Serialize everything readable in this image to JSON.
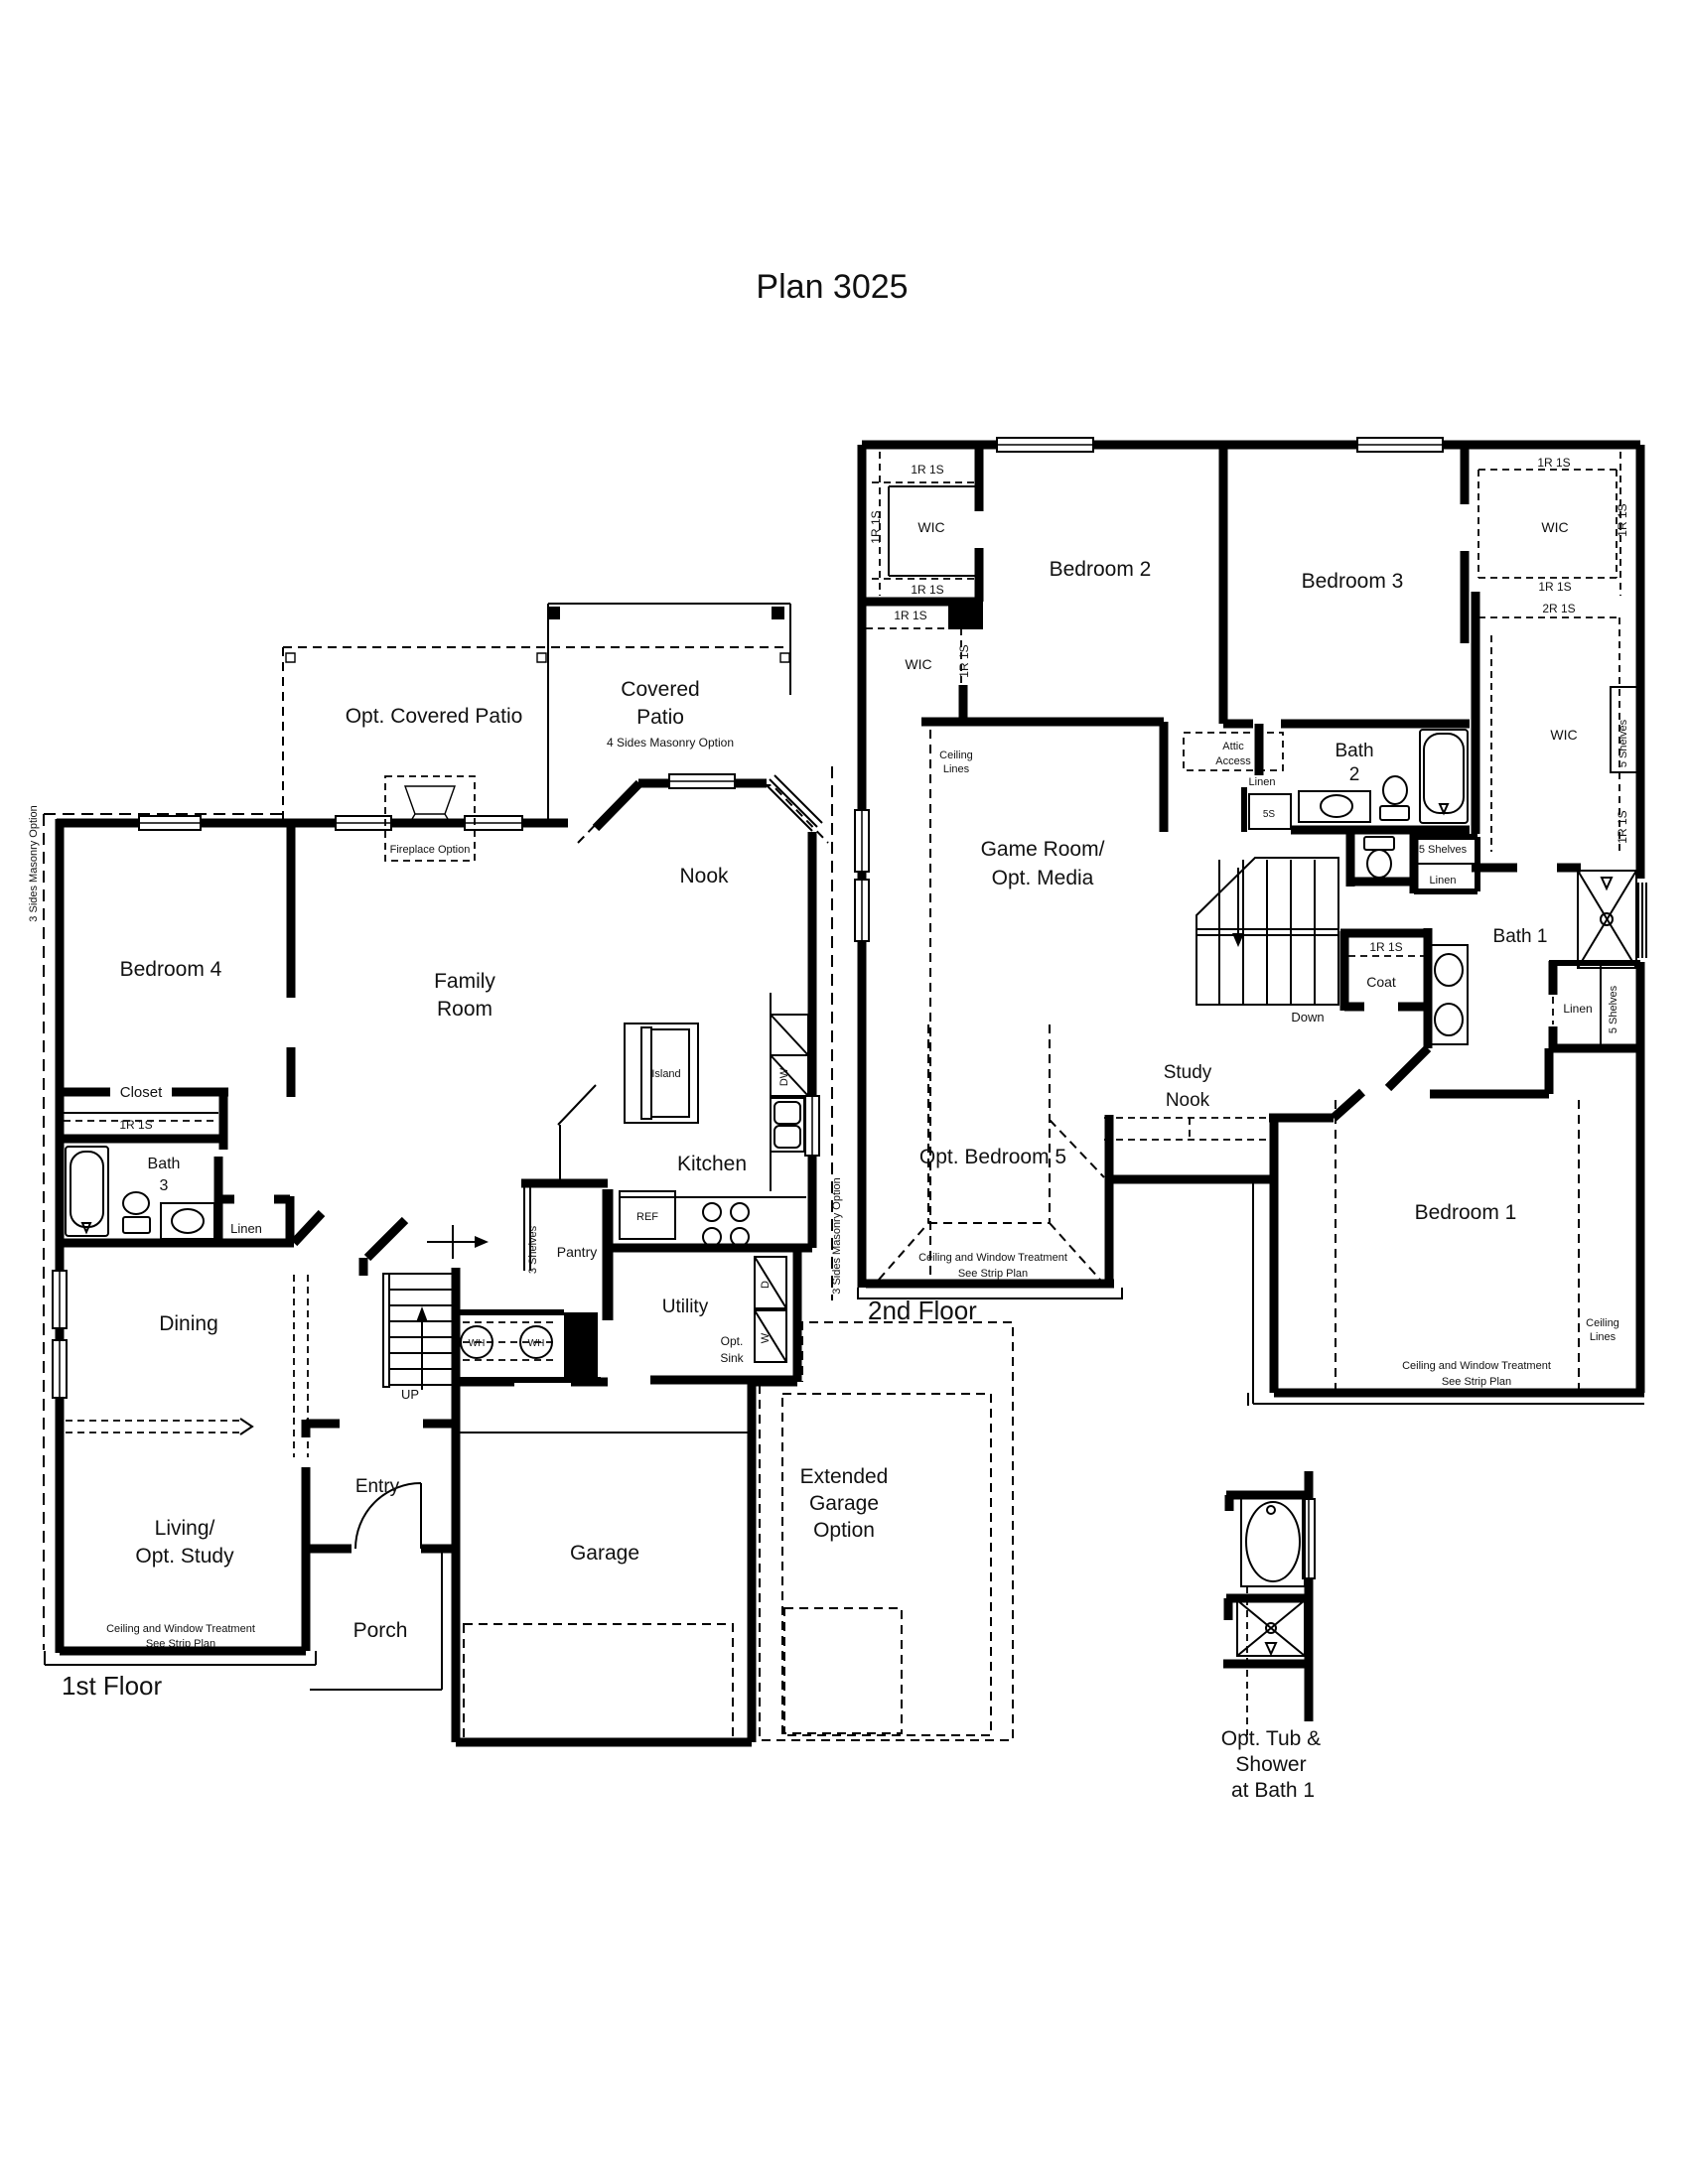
{
  "title": "Plan 3025",
  "colors": {
    "ink": "#111111",
    "paper": "#ffffff"
  },
  "floor1": {
    "floor_label": "1st Floor",
    "opt_covered_patio": "Opt. Covered Patio",
    "covered_patio": [
      "Covered",
      "Patio"
    ],
    "masonry_4s": "4 Sides Masonry Option",
    "masonry_3s": "3 Sides Masonry Option",
    "fireplace": "Fireplace Option",
    "nook": "Nook",
    "bedroom4": "Bedroom 4",
    "family_room": [
      "Family",
      "Room"
    ],
    "island": "Island",
    "closet": "Closet",
    "rod_1r1s": "1R 1S",
    "bath3": [
      "Bath",
      "3"
    ],
    "linen": "Linen",
    "kitchen": "Kitchen",
    "ref": "REF",
    "dw": "DW",
    "pantry": "Pantry",
    "shelves_3": "3 Shelves",
    "dining": "Dining",
    "utility": "Utility",
    "opt_sink": [
      "Opt.",
      "Sink"
    ],
    "dryer": "D",
    "washer": "W",
    "water_heater": "WH",
    "up": "UP",
    "entry": "Entry",
    "living": [
      "Living/",
      "Opt. Study"
    ],
    "treatment_note": [
      "Ceiling and Window Treatment",
      "See Strip Plan"
    ],
    "garage": "Garage",
    "porch": "Porch",
    "extended_garage": [
      "Extended",
      "Garage",
      "Option"
    ]
  },
  "floor2": {
    "floor_label": "2nd Floor",
    "wic": "WIC",
    "rod_1r1s": "1R 1S",
    "rod_2r1s": "2R 1S",
    "bedroom2": "Bedroom 2",
    "bedroom3": "Bedroom 3",
    "ceiling_lines": [
      "Ceiling",
      "Lines"
    ],
    "attic_access": [
      "Attic",
      "Access"
    ],
    "linen": "Linen",
    "linen_5s": "5S",
    "shelves_5": "5 Shelves",
    "bath2": [
      "Bath",
      "2"
    ],
    "game_room": [
      "Game Room/",
      "Opt. Media"
    ],
    "bath1": "Bath 1",
    "coat": "Coat",
    "down": "Down",
    "study_nook": [
      "Study",
      "Nook"
    ],
    "opt_bedroom5": "Opt. Bedroom 5",
    "bedroom1": "Bedroom 1",
    "treatment_note": [
      "Ceiling and Window Treatment",
      "See Strip Plan"
    ]
  },
  "detail": {
    "opt_tub_shower": [
      "Opt. Tub &",
      "Shower",
      "at Bath 1"
    ]
  }
}
